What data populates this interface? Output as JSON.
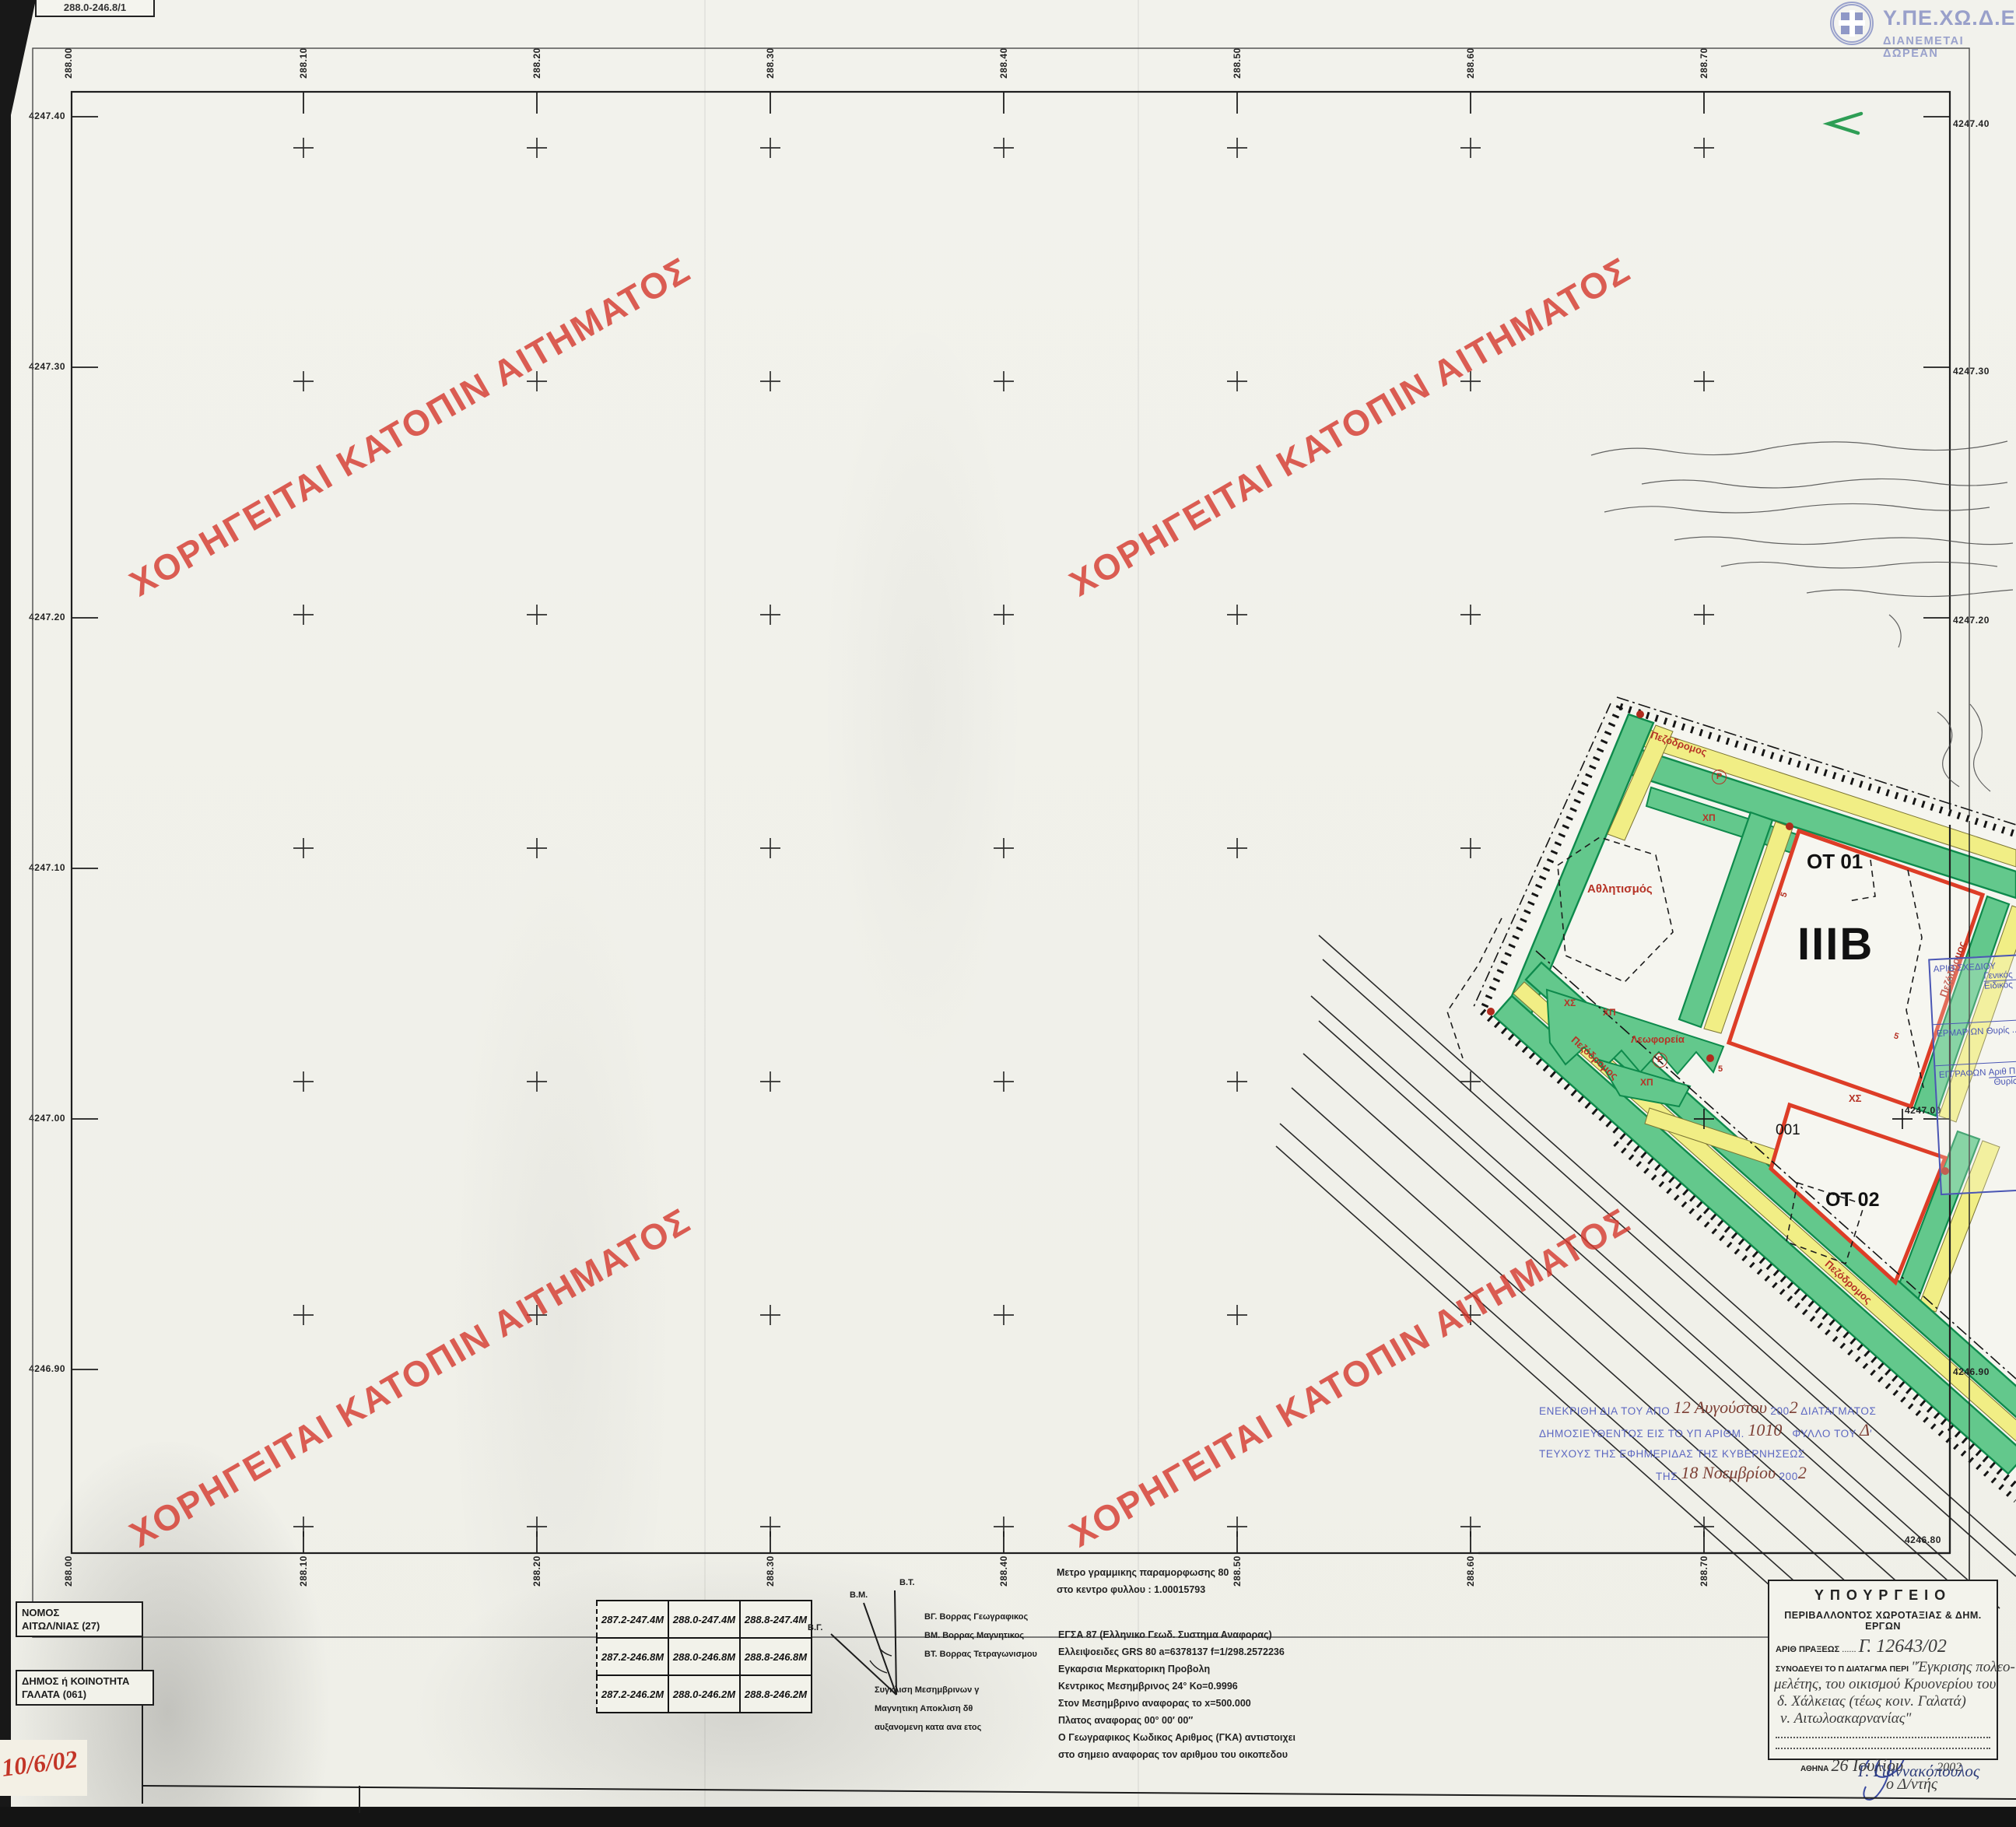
{
  "corner_label": "288.0-246.8/1",
  "logo": {
    "title": "Υ.ΠΕ.ΧΩ.Δ.Ε.",
    "subtitle": "ΔΙΑΝΕΜΕΤΑΙ ΔΩΡΕΑΝ"
  },
  "watermark": {
    "text": "ΧΟΡΗΓΕΙΤΑΙ ΚΑΤΟΠΙΝ ΑΙΤΗΜΑΤΟΣ"
  },
  "grid": {
    "top_labels": [
      "288.00",
      "288.10",
      "288.20",
      "288.30",
      "288.40",
      "288.50",
      "288.60",
      "288.70"
    ],
    "bottom_labels": [
      "288.00",
      "288.10",
      "288.20",
      "288.30",
      "288.40",
      "288.50",
      "288.60",
      "288.70"
    ],
    "left_labels": [
      "4247.40",
      "4247.30",
      "4247.20",
      "4247.10",
      "4247.00",
      "4246.90",
      "4246.80"
    ],
    "right_labels": [
      "4247.40",
      "4247.30",
      "4247.20",
      "4247.10",
      "4247.00",
      "4246.90",
      "4246.80"
    ]
  },
  "plan": {
    "ot01": "ΟΤ 01",
    "sector": "ΙΙΙΒ",
    "ot02": "ΟΤ 02",
    "parcel": "001",
    "sports": "Αθλητισμός",
    "buses": "Λεωφορεία",
    "pedestrian": "Πεζόδρομος",
    "xp": "ΧΠ",
    "xs": "ΧΣ",
    "p_symbol": "Ρ",
    "five": "5"
  },
  "approval_stamp": {
    "l1a": "ΕΝΕΚΡΙΘΗ ΔΙΑ ΤΟΥ ΑΠΟ",
    "l1hw": "12 Αυγούστου",
    "l1b": "200",
    "l1hw2": "2",
    "l1c": "ΔΙΑΤΑΓΜΑΤΟΣ",
    "l2a": "ΔΗΜΟΣΙΕΥΘΕΝΤΟΣ ΕΙΣ ΤΟ ΥΠ ΑΡΙΘΜ.",
    "l2hw": "1010",
    "l2b": "ΦΥΛΛΟ ΤΟΥ",
    "l2hw2": "Δ",
    "l3": "ΤΕΥΧΟΥΣ ΤΗΣ ΕΦΗΜΕΡΙΔΑΣ ΤΗΣ ΚΥΒΕΡΝΗΣΕΩΣ",
    "l4a": "ΤΗΣ",
    "l4hw": "18 Νοεμβρίου",
    "l4b": "200",
    "l4hw2": "2"
  },
  "filing_stamp": {
    "row1_label": "ΑΡΙΘ ΣΧΕΔΙΟΥ",
    "row1_a": "Γενικός",
    "row1_b": "Ειδικός",
    "row2_label": "ΕΡΜΑΡΙΩΝ",
    "row2_a": "Θυρίς",
    "row3_label": "ΕΓΓΡΑΦΩΝ",
    "row3_a": "Αριθ Πρ",
    "row3_b": "Θυρίς"
  },
  "ministry_stamp": {
    "title": "ΥΠΟΥΡΓΕΙΟ",
    "subtitle": "ΠΕΡΙΒΑΛΛΟΝΤΟΣ ΧΩΡΟΤΑΞΙΑΣ & ΔΗΜ. ΕΡΓΩΝ",
    "praxis_label": "ΑΡΙΘ ΠΡΑΞΕΩΣ",
    "praxis_value": "Γ. 12643/02",
    "decree_label": "ΣΥΝΟΔΕΥΕΙ ΤΟ Π ΔΙΑΤΑΓΜΑ ΠΕΡΙ",
    "hw1": "\"Έγκρισης πολεο-",
    "hw2": "μελέτης, του οικισμού Κρυονερίου του",
    "hw3": "δ. Χάλκειας (τέως κοιν. Γαλατά)",
    "hw4": "ν. Αιτωλοακαρνανίας\"",
    "city": "ΑΘΗΝΑ",
    "date_hw": "26 Ιουλίου",
    "year_hw": "2002",
    "role_hw": "ο Δ/ντής",
    "signature": "Γ. Γιαννακόπουλος"
  },
  "region_boxes": {
    "nomos_line1": "ΝΟΜΟΣ",
    "nomos_line2": "ΑΙΤΩΛ/ΝΙΑΣ (27)",
    "dimos_line1": "ΔΗΜΟΣ ή ΚΟΙΝΟΤΗΤΑ",
    "dimos_line2": "ΓΑΛΑΤΑ (061)"
  },
  "hand_date": "10/6/02",
  "sheet_table": {
    "rows": [
      [
        "287.2-247.4Μ",
        "288.0-247.4Μ",
        "288.8-247.4Μ"
      ],
      [
        "287.2-246.8Μ",
        "288.0-246.8Μ",
        "288.8-246.8Μ"
      ],
      [
        "287.2-246.2Μ",
        "288.0-246.2Μ",
        "288.8-246.2Μ"
      ]
    ]
  },
  "north": {
    "bg": "Β.Γ.",
    "bm": "Β.Μ.",
    "bt": "Β.Τ.",
    "leg1": "ΒΓ. Βορρας Γεωγραφικος",
    "leg2": "ΒΜ. Βορρας Μαγνητικος",
    "leg3": "ΒΤ. Βορρας Τετραγωνισμου",
    "sub1": "Συγκλιση Μεσημβρινων γ",
    "sub2": "Μαγνητικη Αποκλιση δθ",
    "sub3": "αυξανομενη κατα      ανα ετος"
  },
  "projection": {
    "note1": "Μετρο γραμμικης παραμορφωσης 80",
    "note2": "στο κεντρο φυλλου : 1.00015793",
    "l1": "ΕΓΣΑ 87 (Ελληνικο Γεωδ. Συστημα Αναφορας)",
    "l2": "Ελλειψοειδες GRS 80  a=6378137   f=1/298.2572236",
    "l3": "Εγκαρσια Μερκατορικη Προβολη",
    "l4": "Κεντρικος Μεσημβρινος 24°  Κο=0.9996",
    "l5": "Στον Μεσημβρινο αναφορας το x=500.000",
    "l6": "Πλατος αναφορας 00° 00′ 00″",
    "l7": "Ο Γεωγραφικος Κωδικος Αριθμος (ΓΚΑ) αντιστοιχει",
    "l8": "στο σημειο αναφορας τον αριθμου του οικοπεδου"
  },
  "colors": {
    "plan_green": "#63c88c",
    "plan_green_edge": "#0e8a4c",
    "plan_yellow": "#f1ee85",
    "block_red": "#dd3d27",
    "label_red": "#b63326",
    "stamp_blue": "#5d68c2",
    "filing_blue": "#4a56b4",
    "logo_periwinkle": "#99a0ca",
    "watermark_red": "#d4372c",
    "hand_red": "#c33527",
    "ink_blue": "#3a4aa0"
  }
}
